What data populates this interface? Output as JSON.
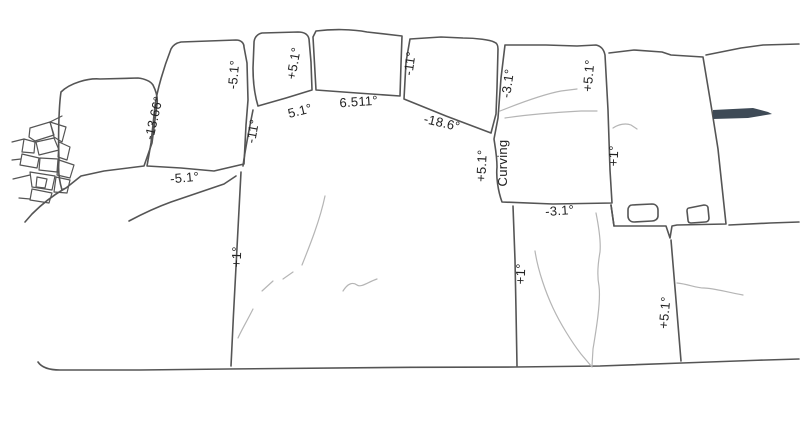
{
  "drawing": {
    "background": "#ffffff",
    "outline_color": "#555555",
    "crack_color": "#b5b5b5",
    "wedge_color": "#3e4a56",
    "label_color": "#222222",
    "description": "Line drawing of a polygonal stone wall elevation annotated with joint angles"
  },
  "labels": [
    {
      "id": "joint-ab",
      "text": "-13.66°"
    },
    {
      "id": "joint-bc",
      "text": "-5.1°"
    },
    {
      "id": "joint-m-topleft",
      "text": "-11°"
    },
    {
      "id": "joint-b-bottom",
      "text": "-5.1°"
    },
    {
      "id": "joint-cd",
      "text": "+5.1°"
    },
    {
      "id": "joint-c-bottom",
      "text": "5.1°"
    },
    {
      "id": "joint-d-bottom",
      "text": "6.511°"
    },
    {
      "id": "joint-de",
      "text": "-11°"
    },
    {
      "id": "joint-e-bottom",
      "text": "-18.6°"
    },
    {
      "id": "joint-ef",
      "text": "-3.1°"
    },
    {
      "id": "joint-fg-upper",
      "text": "+5.1°"
    },
    {
      "id": "joint-mf",
      "text": "+5.1°"
    },
    {
      "id": "joint-mf-note",
      "text": "Curving"
    },
    {
      "id": "joint-fg-lower",
      "text": "+1°"
    },
    {
      "id": "joint-f-bottom",
      "text": "-3.1°"
    },
    {
      "id": "joint-lm",
      "text": "+1°"
    },
    {
      "id": "joint-mn",
      "text": "+1°"
    },
    {
      "id": "joint-no",
      "text": "+5.1°"
    }
  ]
}
